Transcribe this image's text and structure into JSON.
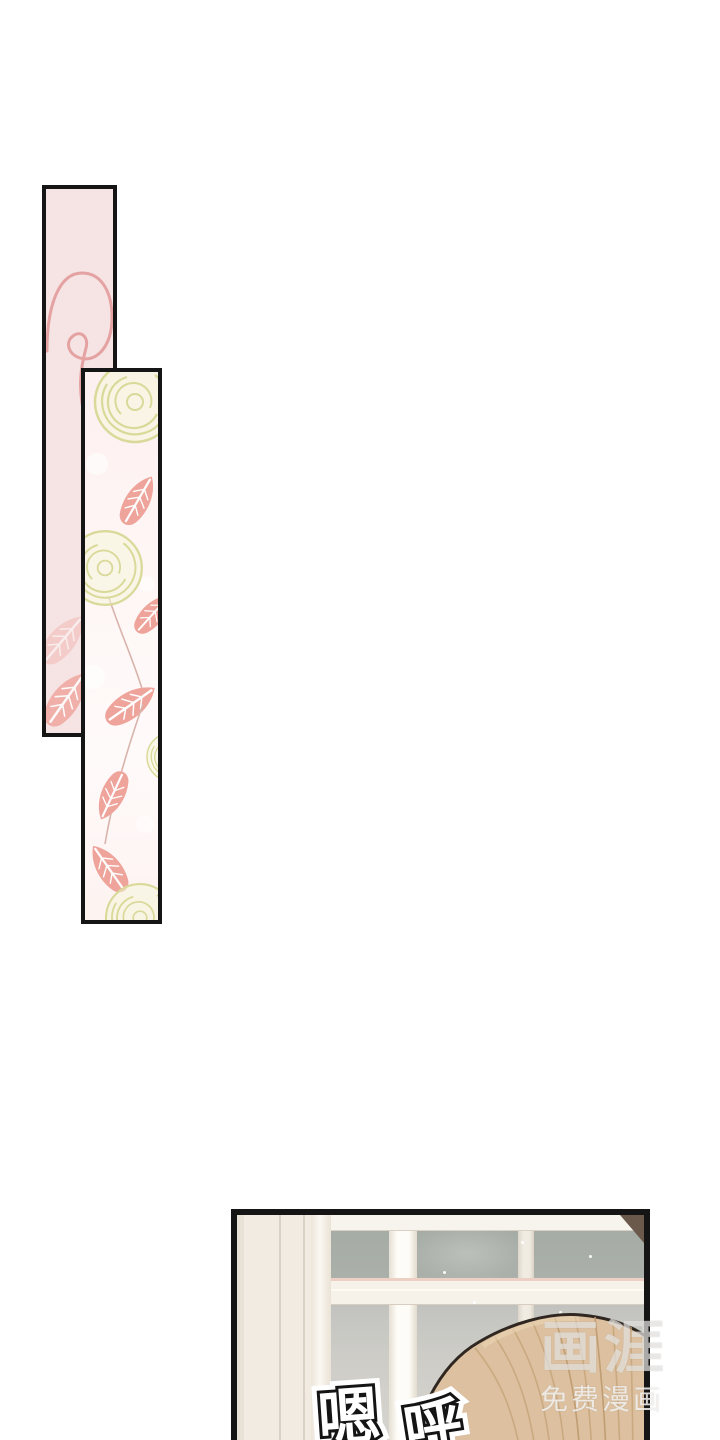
{
  "watermark": {
    "logo": "画涯",
    "tagline": "免费漫画"
  },
  "sfx": {
    "char1": "嗯",
    "char2": "呼"
  },
  "colors": {
    "page_bg": "#ffffff",
    "panel_border": "#151515",
    "floral_panel1_bg": "#f6e3e3",
    "rose_outline": "#e4a2a2",
    "yellow_rose_stroke": "#d9d99a",
    "yellow_rose_fill": "#f6f6da",
    "pink_leaf": "#efa49b",
    "window_glass_upper": "#a6ada6",
    "window_glass_lower": "#dcd9d4",
    "window_frame_white": "#fdfbf5",
    "wall_cream": "#f1ebe2",
    "crossbar_pink_accent": "#edcfc3",
    "hair_base": "#dcc09f",
    "hair_strand": "#c8a77d",
    "hair_outline": "#2f2720",
    "corner_shadow": "#6b5a4c",
    "sfx_fill": "#ffffff",
    "sfx_stroke": "#141414"
  }
}
